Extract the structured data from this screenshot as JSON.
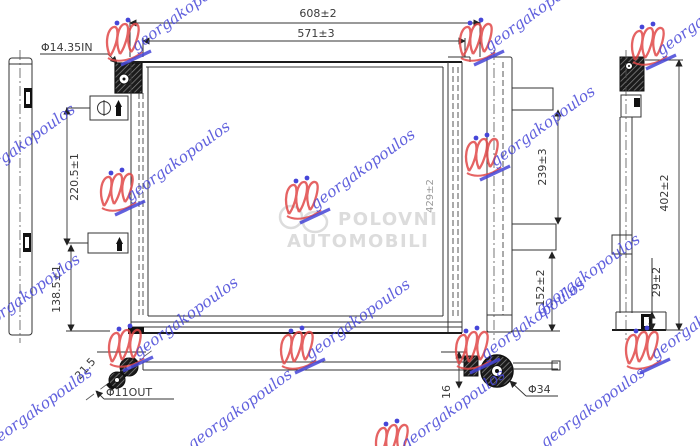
{
  "drawing": {
    "dimensions": {
      "overall_width": "608±2",
      "core_width": "571±3",
      "inlet_label": "Φ14.35IN",
      "left_upper": "220.5±1",
      "left_lower": "138.5±1",
      "core_height": "429±2",
      "right_upper": "239±3",
      "right_lower": "152±2",
      "overall_height": "402±2",
      "depth": "29±2",
      "outlet_angle": "21.5",
      "outlet_label": "Φ11OUT",
      "offset": "16",
      "pipe_diameter": "Φ34"
    }
  },
  "watermarks": {
    "script_text": "georgakopoulos",
    "script_color": "#4646d8",
    "crest_color": "#e04848",
    "brand_line1": "POLOVNI",
    "brand_line2": "AUTOMOBILI",
    "brand_color": "#dcdcdc"
  }
}
